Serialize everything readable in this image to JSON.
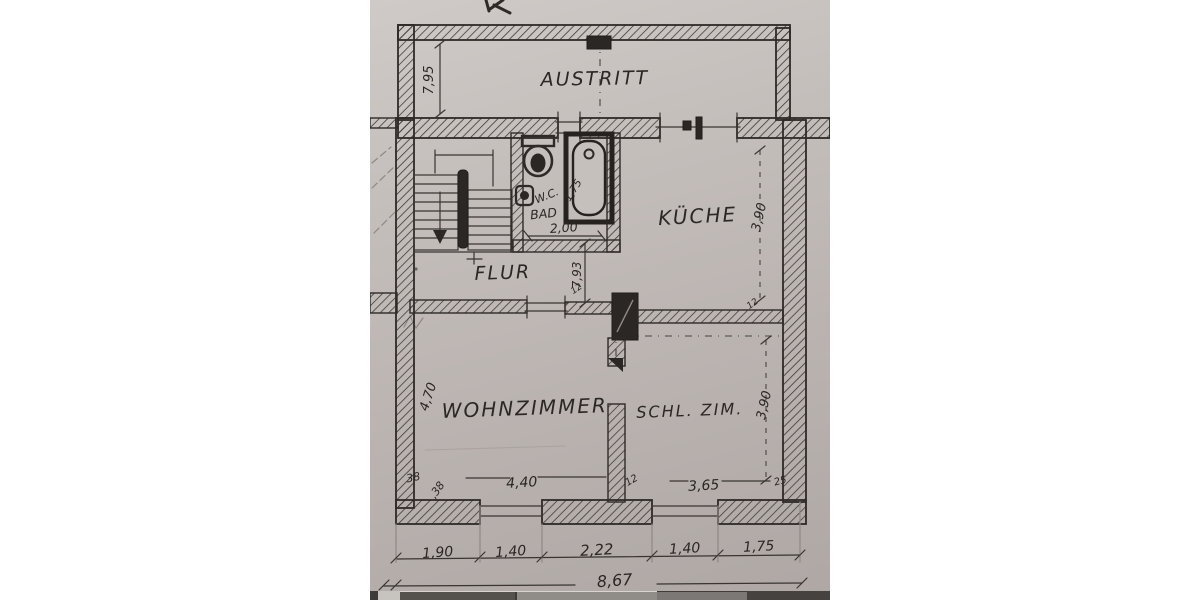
{
  "floorplan": {
    "rooms": {
      "austritt": "AUSTRITT",
      "kueche": "KÜCHE",
      "flur": "FLUR",
      "wc": "W.C.",
      "bad": "BAD",
      "wohnzimmer": "WOHNZIMMER",
      "schlafzimmer": "SCHL. ZIM."
    },
    "dims": {
      "balcony_length": "7,95",
      "kueche_depth": "3,90",
      "interior_depth": "7,93",
      "bad_width": "2,00",
      "bad_diag": "1,75",
      "wohn_depth": "4,70",
      "wohn_width": "4,40",
      "schlaf_width": "3,65",
      "schlaf_depth": "3,90",
      "wall_38": "38",
      "wall_38_b": ",38",
      "wall_12_a": "12",
      "wall_12_b": "12",
      "wall_12_c": "12",
      "wall_25": "25"
    },
    "bottom_dims": {
      "segments": [
        "1,90",
        "1,40",
        "2,22",
        "1,40",
        "1,75"
      ],
      "total": "8,67"
    }
  }
}
